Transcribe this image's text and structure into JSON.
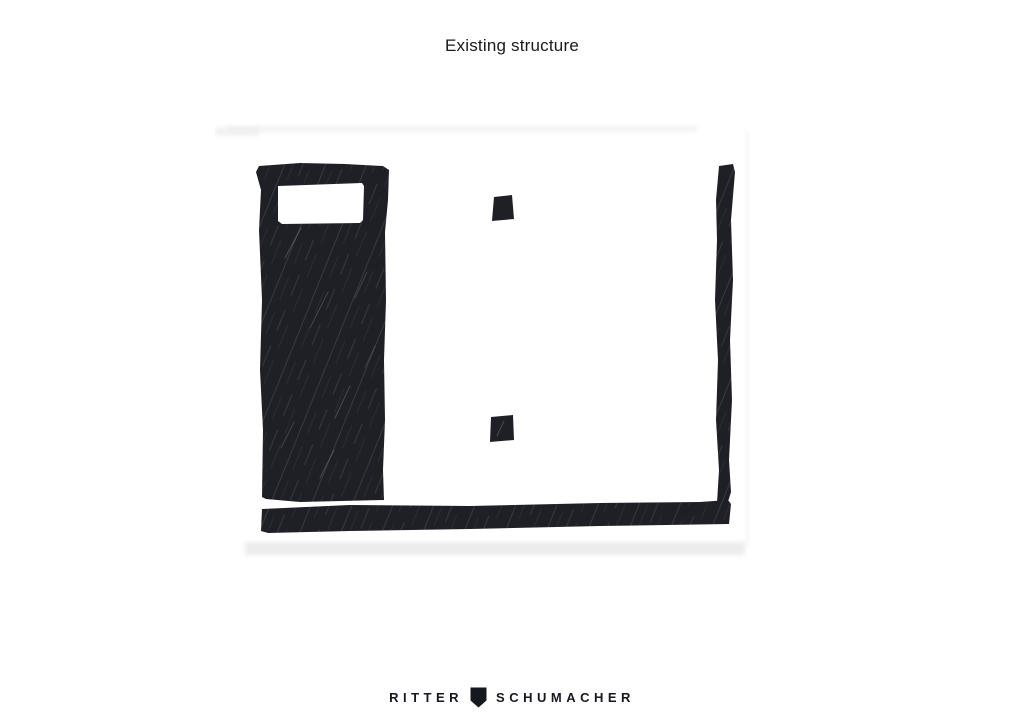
{
  "title": {
    "text": "Existing structure"
  },
  "sketch": {
    "type": "hand-drawn architectural plan sketch",
    "elements": [
      "existing-wall-left",
      "window-opening",
      "column-upper",
      "column-lower",
      "existing-wall-right",
      "existing-wall-bottom"
    ],
    "colors": {
      "ink": "#1f1f26",
      "texture_streak": "#6c6c76",
      "paper": "#ffffff",
      "scan_shadow": "#e9e9e9"
    }
  },
  "logo": {
    "ritter": "RITTER",
    "schumacher": "SCHUMACHER",
    "icon": "shield-icon",
    "color": "#17171f"
  }
}
